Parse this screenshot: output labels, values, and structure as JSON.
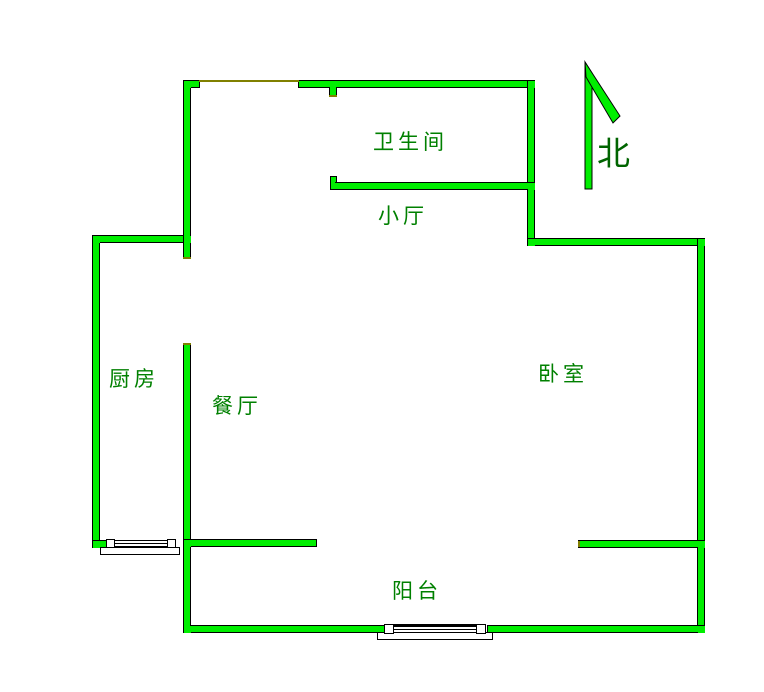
{
  "colors": {
    "canvas_bg": "#ffffff",
    "wall_fill": "#00ee00",
    "wall_outline": "#000000",
    "label_text": "#008000",
    "north_text": "#006400",
    "door_marker": "#808000",
    "window_fill": "#ffffff"
  },
  "rooms": {
    "bathroom": "卫生间",
    "hall": "小厅",
    "kitchen": "厨房",
    "dining": "餐厅",
    "bedroom": "卧室",
    "balcony": "阳台"
  },
  "compass": {
    "label": "北"
  }
}
